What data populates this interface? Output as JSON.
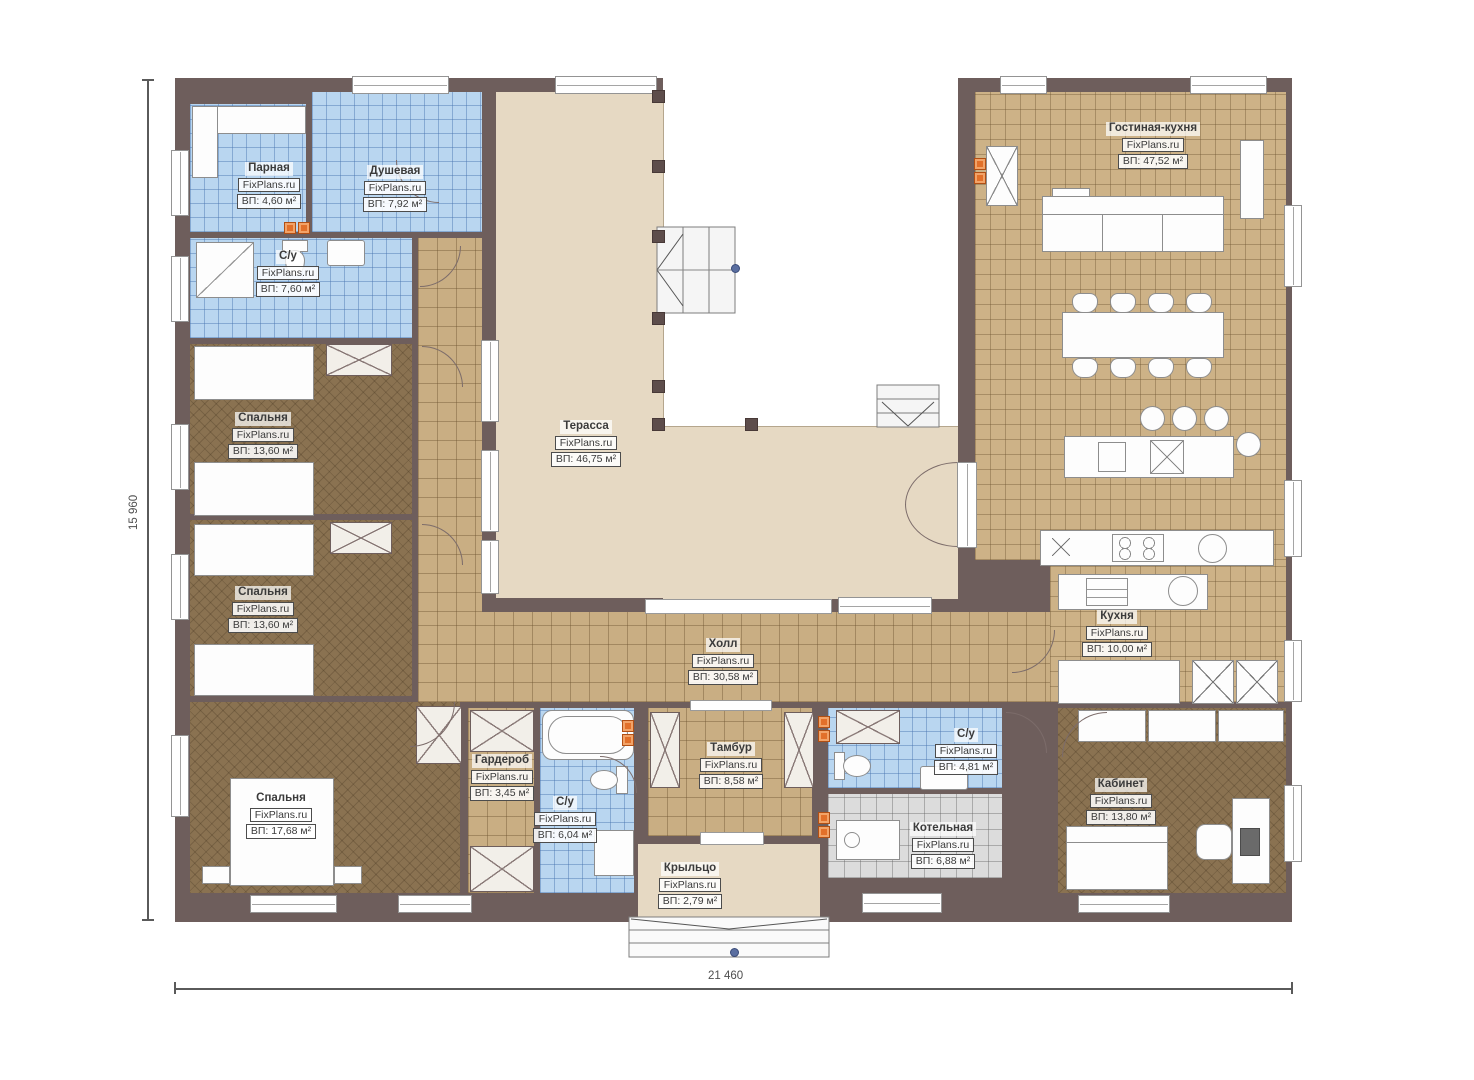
{
  "brand": "FixPlans.ru",
  "dimensions": {
    "height_label": "15 960",
    "width_label": "21 460"
  },
  "rooms": [
    {
      "name": "Парная",
      "area": "ВП: 4,60 м²"
    },
    {
      "name": "Душевая",
      "area": "ВП: 7,92 м²"
    },
    {
      "name": "С/у",
      "area": "ВП: 7,60 м²"
    },
    {
      "name": "Спальня",
      "area": "ВП: 13,60 м²"
    },
    {
      "name": "Спальня",
      "area": "ВП: 13,60 м²"
    },
    {
      "name": "Спальня",
      "area": "ВП: 17,68 м²"
    },
    {
      "name": "Терасса",
      "area": "ВП: 46,75 м²"
    },
    {
      "name": "Холл",
      "area": "ВП: 30,58 м²"
    },
    {
      "name": "Гостиная-кухня",
      "area": "ВП: 47,52 м²"
    },
    {
      "name": "Кухня",
      "area": "ВП: 10,00 м²"
    },
    {
      "name": "Гардероб",
      "area": "ВП: 3,45 м²"
    },
    {
      "name": "С/у",
      "area": "ВП: 6,04 м²"
    },
    {
      "name": "Тамбур",
      "area": "ВП: 8,58 м²"
    },
    {
      "name": "С/у",
      "area": "ВП: 4,81 м²"
    },
    {
      "name": "Котельная",
      "area": "ВП: 6,88 м²"
    },
    {
      "name": "Кабинет",
      "area": "ВП: 13,80 м²"
    },
    {
      "name": "Крыльцо",
      "area": "ВП: 2,79 м²"
    }
  ],
  "colors": {
    "wall": "#6e5e5c",
    "terrace": "#e6d9c3",
    "tile_tan": "#c9ae83",
    "tile_blue": "#b9d6f0",
    "carpet": "#8a7251",
    "tile_gray": "#dcdcdc",
    "marker_orange": "#e2702a"
  }
}
